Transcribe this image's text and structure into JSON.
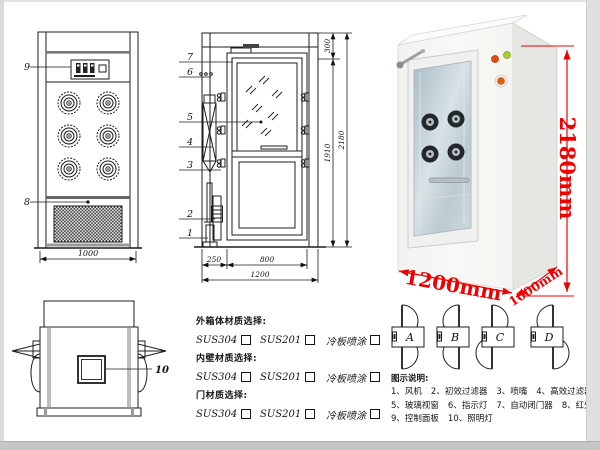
{
  "front_view": {
    "leader_9": "9",
    "leader_8": "8",
    "dim_width": "1000"
  },
  "side_view": {
    "leaders": [
      "7",
      "6",
      "5",
      "4",
      "3",
      "2",
      "1"
    ],
    "dim_top": "300",
    "dim_inner_height": "1910",
    "dim_total_height": "2180",
    "dim_left": "250",
    "dim_door": "800",
    "dim_total_width": "1200"
  },
  "photo": {
    "dim_height": "2180mm",
    "dim_width": "1200mm",
    "dim_depth": "1000mm",
    "accent_color": "#f00000"
  },
  "top_view": {
    "leader_10": "10"
  },
  "materials": {
    "sections": [
      {
        "title": "外箱体材质选择:",
        "options": [
          "SUS304",
          "SUS201",
          "冷板喷涂"
        ]
      },
      {
        "title": "内壁材质选择:",
        "options": [
          "SUS304",
          "SUS201",
          "冷板喷涂"
        ]
      },
      {
        "title": "门材质选择:",
        "options": [
          "SUS304",
          "SUS201",
          "冷板喷涂"
        ]
      }
    ]
  },
  "door_configs": {
    "labels": [
      "A",
      "B",
      "C",
      "D"
    ]
  },
  "legend": {
    "title": "图示说明:",
    "items": [
      "1、风机",
      "2、初效过滤器",
      "3、喷嘴",
      "4、高效过滤器",
      "5、玻璃视窗",
      "6、指示灯",
      "7、自动闭门器",
      "8、红外线感应器",
      "9、控制面板",
      "10、照明灯"
    ]
  }
}
